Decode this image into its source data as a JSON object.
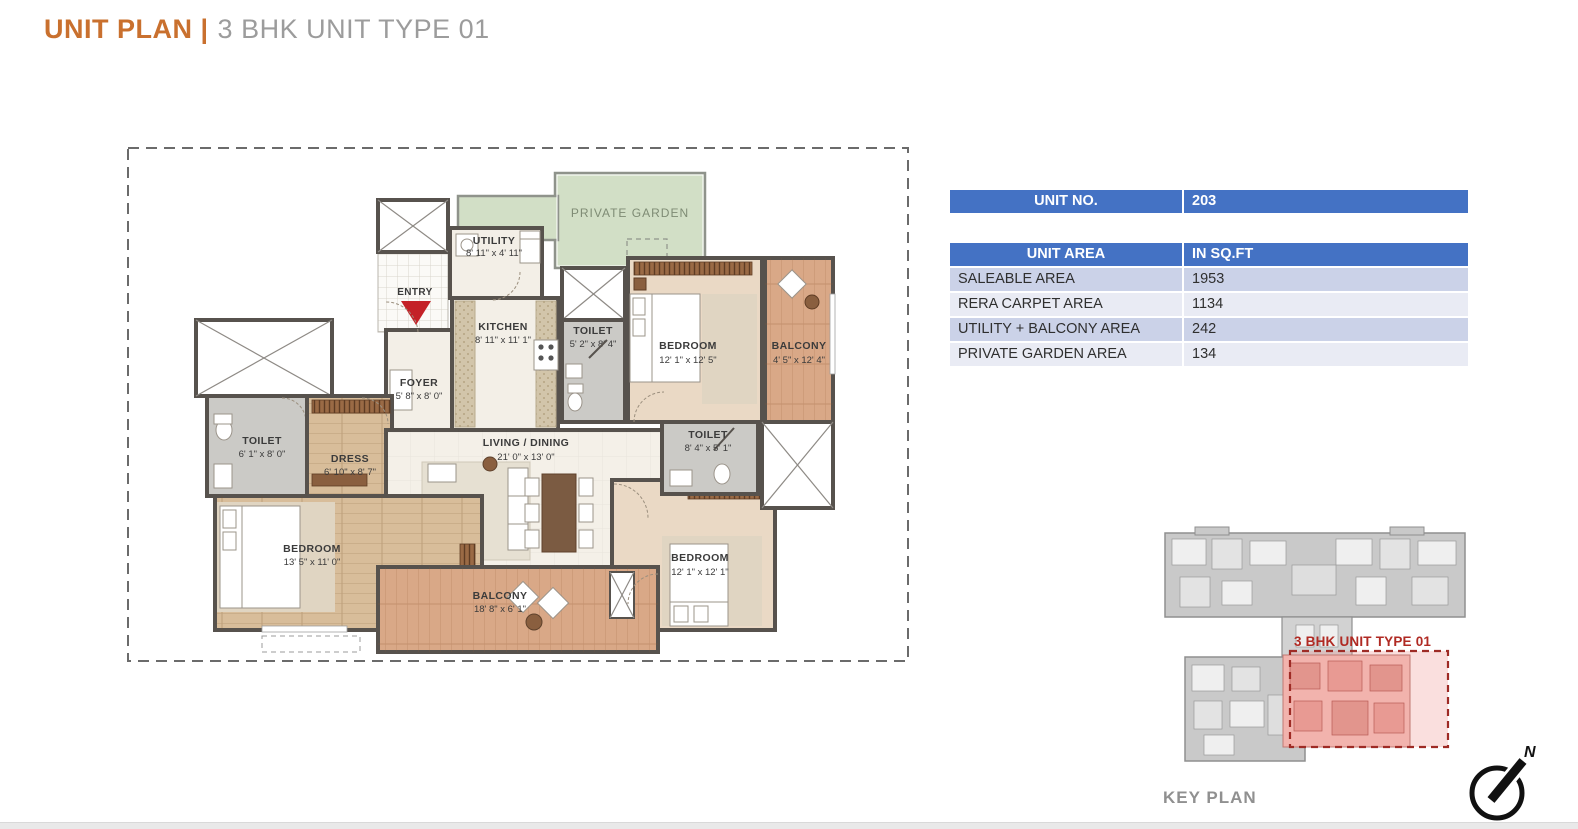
{
  "title": {
    "prefix": "UNIT PLAN |",
    "suffix": "3 BHK UNIT TYPE 01"
  },
  "unit_no_table": {
    "header": "UNIT NO.",
    "value": "203"
  },
  "unit_area_table": {
    "header_left": "UNIT AREA",
    "header_right": "IN SQ.FT",
    "rows": [
      {
        "label": "SALEABLE AREA",
        "value": "1953"
      },
      {
        "label": "RERA CARPET AREA",
        "value": "1134"
      },
      {
        "label": "UTILITY + BALCONY AREA",
        "value": "242"
      },
      {
        "label": "PRIVATE GARDEN AREA",
        "value": "134"
      }
    ]
  },
  "floor_plan": {
    "entry_label": "ENTRY",
    "garden_label": "PRIVATE GARDEN",
    "rooms": [
      {
        "name": "UTILITY",
        "dims": "8' 11\" x 4' 11\""
      },
      {
        "name": "KITCHEN",
        "dims": "8' 11\" x 11' 1\""
      },
      {
        "name": "TOILET",
        "dims": "5' 2\" x 8' 4\""
      },
      {
        "name": "BEDROOM",
        "dims": "12' 1\" x 12' 5\""
      },
      {
        "name": "BALCONY",
        "dims": "4' 5\" x 12' 4\""
      },
      {
        "name": "FOYER",
        "dims": "5' 8\" x 8' 0\""
      },
      {
        "name": "TOILET",
        "dims": "6' 1\" x 8' 0\""
      },
      {
        "name": "DRESS",
        "dims": "6' 10\" x 8' 7\""
      },
      {
        "name": "LIVING / DINING",
        "dims": "21' 0\" x 13' 0\""
      },
      {
        "name": "TOILET",
        "dims": "8' 4\" x 5' 1\""
      },
      {
        "name": "BEDROOM",
        "dims": "13' 5\" x 11' 0\""
      },
      {
        "name": "BALCONY",
        "dims": "18' 8\" x 6' 1\""
      },
      {
        "name": "BEDROOM",
        "dims": "12' 1\" x 12' 1\""
      }
    ]
  },
  "key_plan": {
    "caption": "KEY PLAN",
    "unit_label": "3 BHK UNIT TYPE 01",
    "north_label": "N"
  },
  "colors": {
    "accent_orange": "#c9702e",
    "title_gray": "#9c9c9c",
    "table_blue": "#4472c4",
    "row_dark": "#cbd2e8",
    "row_light": "#e9ebf4",
    "wall": "#57524d",
    "wood_floor": "#d8bd9a",
    "beige_floor": "#ead9c5",
    "balcony_floor": "#d9a887",
    "garden_green": "#d2dfc6",
    "toilet_gray": "#cbcac6",
    "highlight_red": "#b02a23"
  }
}
